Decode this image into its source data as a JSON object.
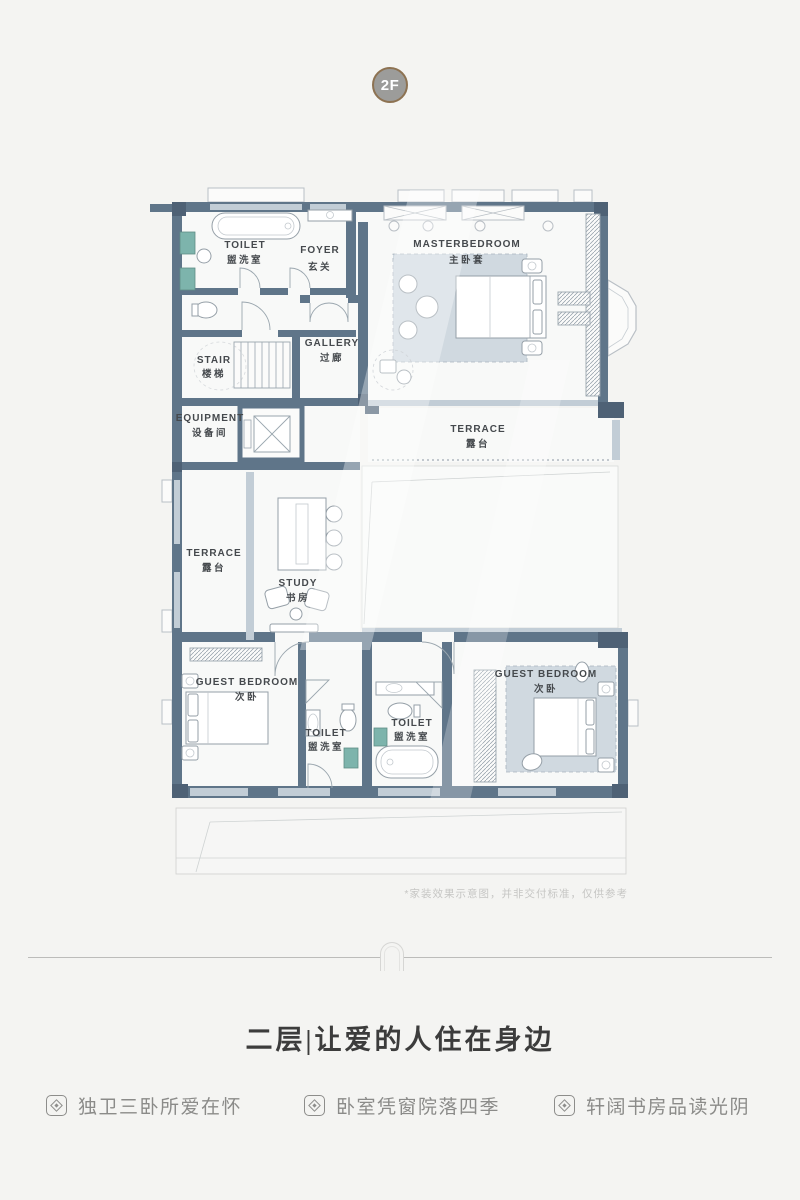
{
  "page": {
    "floor_badge": "2F",
    "disclaimer": "*家装效果示意图，并非交付标准，仅供参考",
    "title": "二层|让爱的人住在身边",
    "features": [
      {
        "label": "独卫三卧所爱在怀"
      },
      {
        "label": "卧室凭窗院落四季"
      },
      {
        "label": "轩阔书房品读光阴"
      }
    ]
  },
  "plan": {
    "rooms": [
      {
        "en": "TOILET",
        "cn": "盥洗室"
      },
      {
        "en": "FOYER",
        "cn": "玄关"
      },
      {
        "en": "MASTERBEDROOM",
        "cn": "主卧套"
      },
      {
        "en": "STAIR",
        "cn": "楼梯"
      },
      {
        "en": "GALLERY",
        "cn": "过廊"
      },
      {
        "en": "EQUIPMENT",
        "cn": "设备间"
      },
      {
        "en": "TERRACE",
        "cn": "露台"
      },
      {
        "en": "TERRACE",
        "cn": "露台"
      },
      {
        "en": "STUDY",
        "cn": "书房"
      },
      {
        "en": "GUEST BEDROOM",
        "cn": "次卧"
      },
      {
        "en": "TOILET",
        "cn": "盥洗室"
      },
      {
        "en": "TOILET",
        "cn": "盥洗室"
      },
      {
        "en": "GUEST BEDROOM",
        "cn": "次卧"
      }
    ],
    "colors": {
      "wall": "#5f7589",
      "wall_dark": "#4e6175",
      "window_light": "#c2cdd6",
      "cabinet_teal": "#7db4ac",
      "rug": "#c9d3dc",
      "badge_ring": "#8d7252",
      "badge_bg": "#9c9c9a",
      "title_text": "#3c3c3c",
      "feature_text": "#8b8b89"
    }
  }
}
